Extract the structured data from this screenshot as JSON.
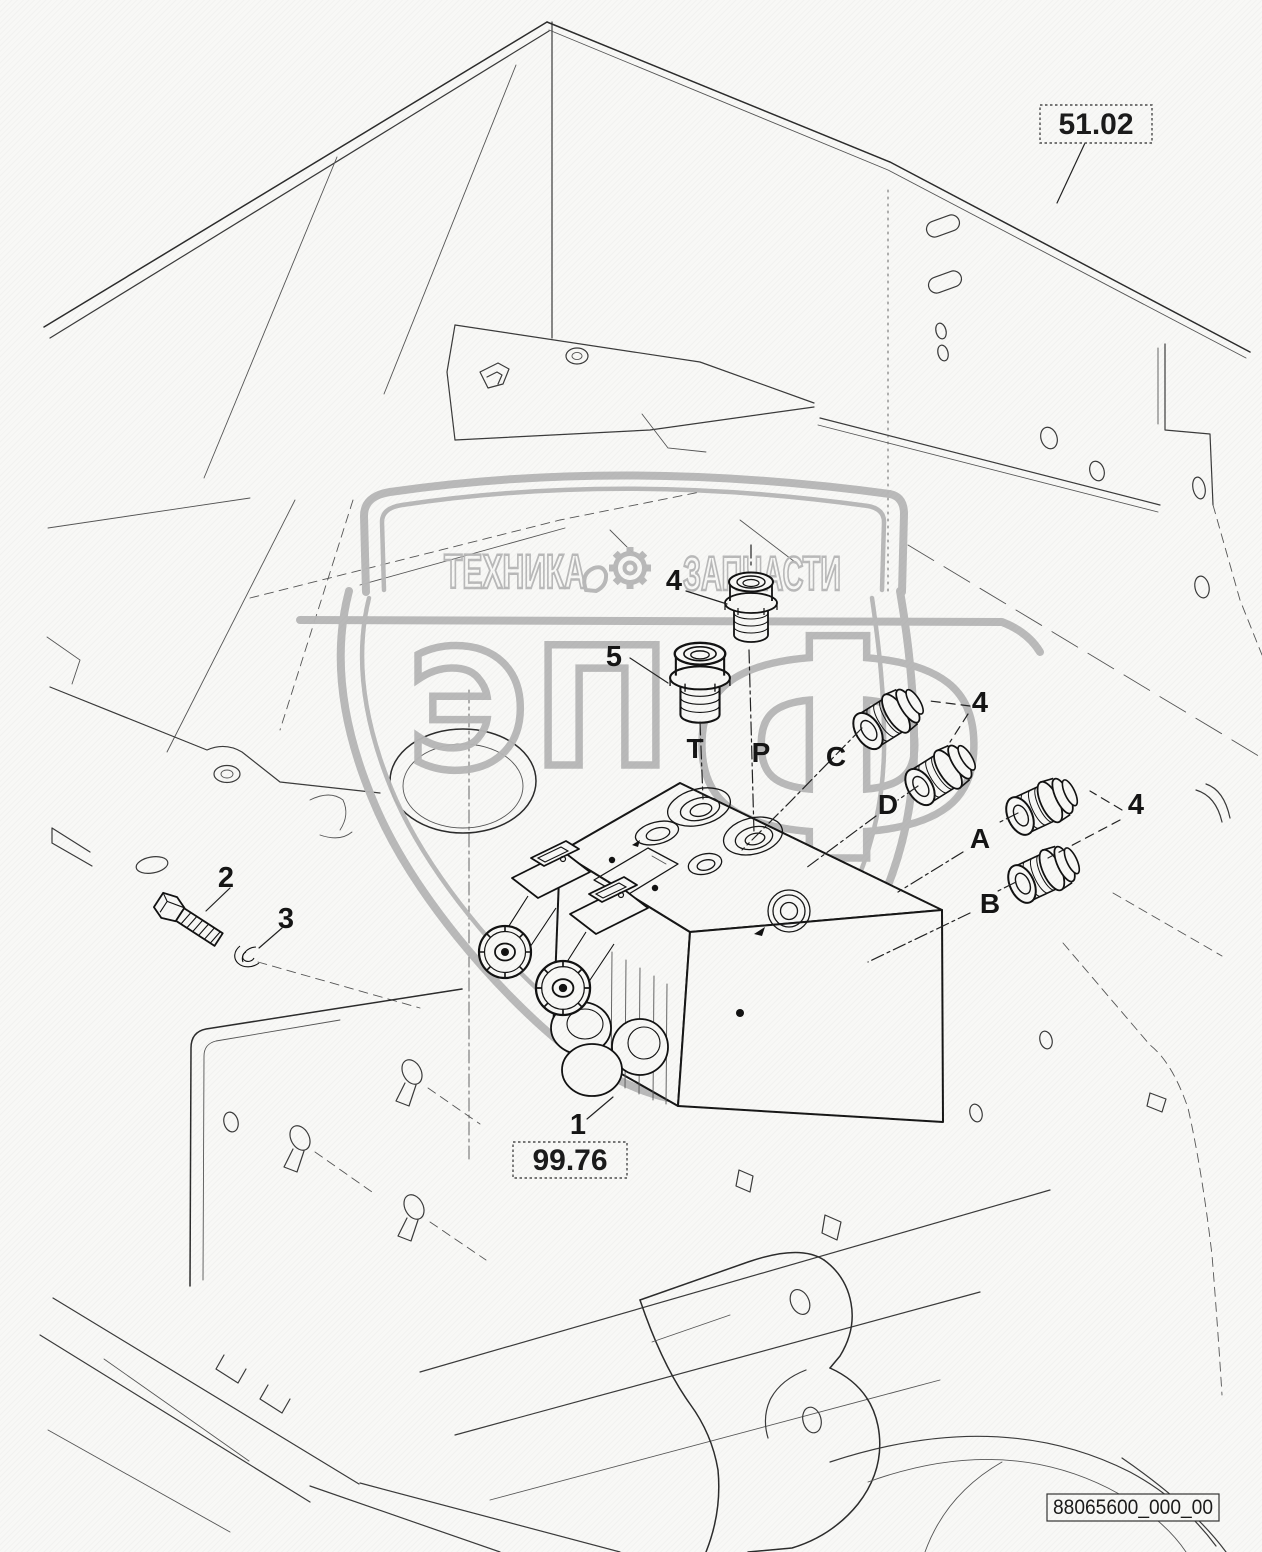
{
  "watermark": {
    "banner_left": "ТЕХНИКА",
    "banner_right": "ЗАПЧАСТИ",
    "monogram_1": "Э",
    "monogram_2": "П",
    "monogram_3": "Ф",
    "color": "#b7b7b7"
  },
  "callouts": {
    "n1": "1",
    "n2": "2",
    "n3": "3",
    "n4": "4",
    "n5": "5"
  },
  "ports": {
    "t": "T",
    "p": "P",
    "c": "C",
    "d": "D",
    "a": "A",
    "b": "B"
  },
  "refs": {
    "section_top": "51.02",
    "section_bottom": "99.76"
  },
  "drawing_number": "88065600_000_00",
  "colors": {
    "line": "#3a3a3a",
    "watermark": "#b7b7b7",
    "background": "#f8f8f6"
  }
}
